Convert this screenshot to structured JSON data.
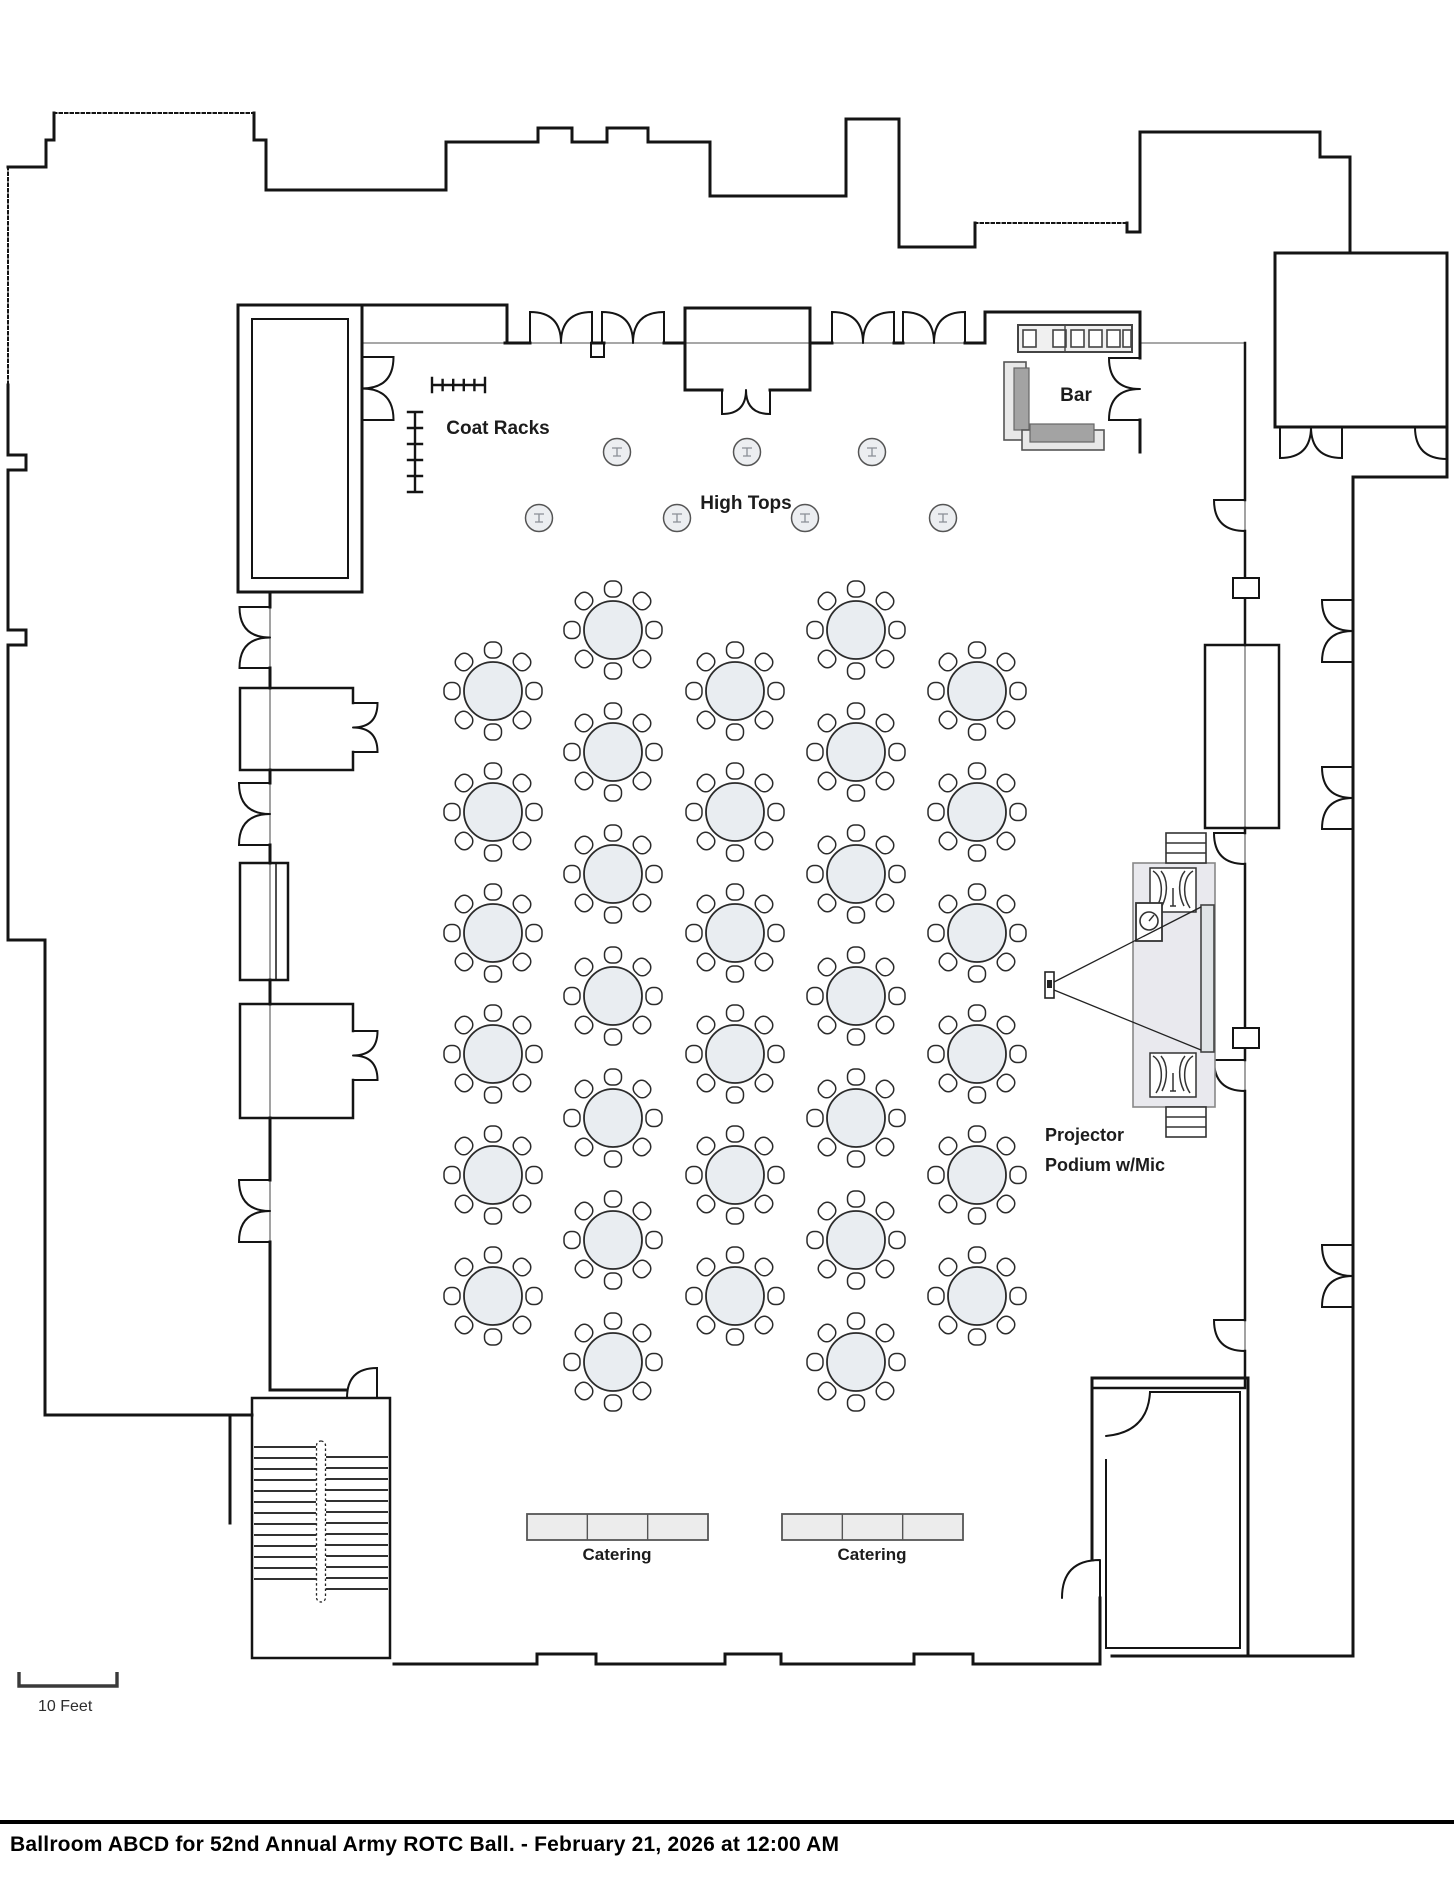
{
  "title_bar": {
    "text": "Ballroom ABCD for 52nd Annual Army ROTC Ball. - February 21, 2026 at 12:00 AM"
  },
  "labels": {
    "coat_racks": "Coat Racks",
    "high_tops": "High Tops",
    "bar": "Bar",
    "projector": "Projector",
    "podium": "Podium w/Mic",
    "scale": "10 Feet"
  },
  "floorplan": {
    "banquet_tables": {
      "count": 32,
      "seats_per_table": 8,
      "table_radius": 29,
      "chair_ring_radius": 44,
      "columns": [
        {
          "x": 493,
          "rows": [
            691,
            812,
            933,
            1054,
            1175,
            1296
          ]
        },
        {
          "x": 613,
          "rows": [
            630,
            752,
            874,
            996,
            1118,
            1240,
            1362
          ]
        },
        {
          "x": 735,
          "rows": [
            691,
            812,
            933,
            1054,
            1175,
            1296
          ]
        },
        {
          "x": 856,
          "rows": [
            630,
            752,
            874,
            996,
            1118,
            1240,
            1362
          ]
        },
        {
          "x": 977,
          "rows": [
            691,
            812,
            933,
            1054,
            1175,
            1296
          ]
        }
      ]
    },
    "high_tops": {
      "count": 7,
      "radius": 13.5,
      "positions": [
        [
          617,
          452
        ],
        [
          747,
          452
        ],
        [
          872,
          452
        ],
        [
          539,
          518
        ],
        [
          677,
          518
        ],
        [
          805,
          518
        ],
        [
          943,
          518
        ]
      ]
    },
    "catering_tables": [
      {
        "label": "Catering",
        "x": 527,
        "y": 1514,
        "w": 181,
        "h": 26,
        "segments": 3,
        "label_x": 617,
        "label_y": 1560
      },
      {
        "label": "Catering",
        "x": 782,
        "y": 1514,
        "w": 181,
        "h": 26,
        "segments": 3,
        "label_x": 872,
        "label_y": 1560
      }
    ],
    "coat_racks": {
      "rack_count": 2
    },
    "bar": {
      "back_counter_squares": 6
    },
    "stage": {
      "items": [
        "projection screen",
        "projector",
        "podium with microphone",
        "speakers"
      ]
    },
    "scale_bar": {
      "represents_feet": 10
    }
  },
  "colors": {
    "wall": "#141414",
    "thin_wall": "#8a8a8a",
    "table_fill": "#e9edf1",
    "chair_fill": "#ffffff",
    "furniture_fill": "#ececec",
    "furniture_dark": "#a3a3a3",
    "stage_fill": "#e9e9ee",
    "label": "#1c1c1c"
  }
}
